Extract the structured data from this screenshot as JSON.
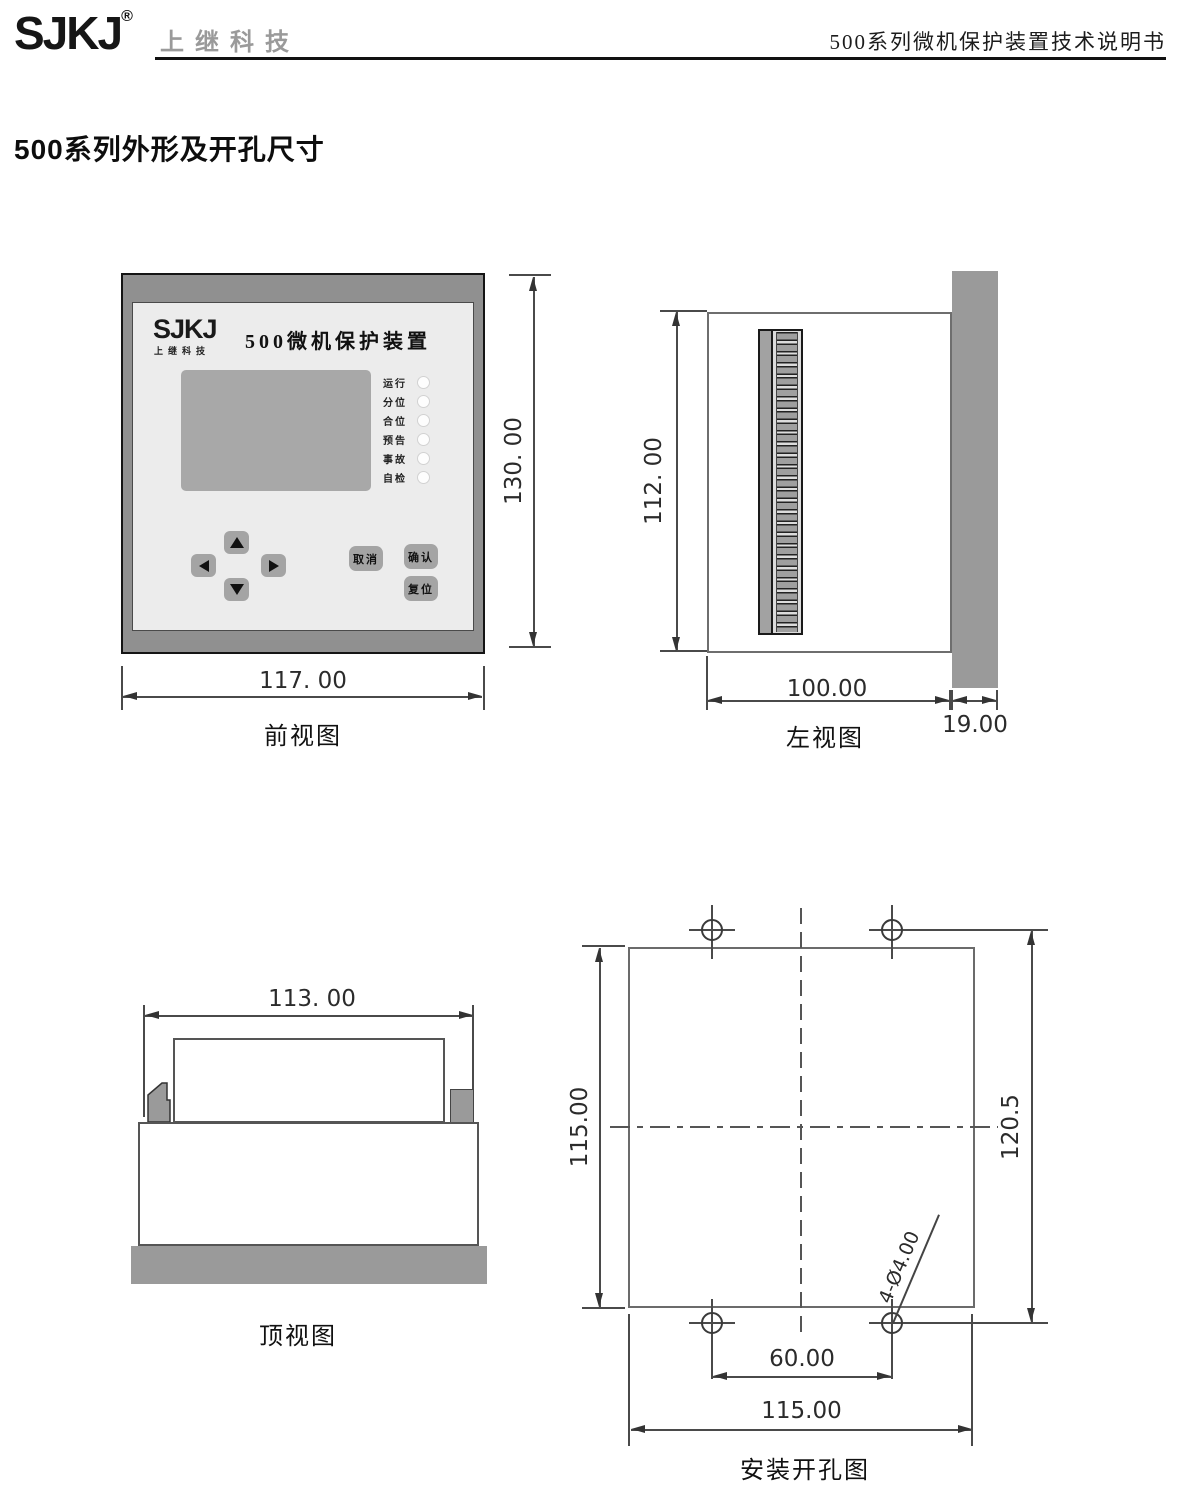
{
  "header": {
    "logo": "SJKJ",
    "logo_reg": "®",
    "logo_sub": "上继科技",
    "doc_title": "500系列微机保护装置技术说明书"
  },
  "heading": "500系列外形及开孔尺寸",
  "front": {
    "label": "前视图",
    "dim_width": "117. 00",
    "dim_height": "130. 00",
    "panel": {
      "logo": "SJKJ",
      "logo_sub": "上继科技",
      "title": "500微机保护装置",
      "leds": [
        {
          "label": "运行"
        },
        {
          "label": "分位"
        },
        {
          "label": "合位"
        },
        {
          "label": "预告"
        },
        {
          "label": "事故"
        },
        {
          "label": "自检"
        }
      ],
      "buttons": {
        "cancel": "取消",
        "confirm": "确认",
        "reset": "复位"
      }
    }
  },
  "left": {
    "label": "左视图",
    "dim_height": "112. 00",
    "dim_depth": "100.00",
    "dim_bezel": "19.00"
  },
  "top": {
    "label": "顶视图",
    "dim_width": "113. 00"
  },
  "cutout": {
    "label": "安装开孔图",
    "dim_side": "115.00",
    "dim_holes_v": "120.5",
    "dim_holes_h": "60.00",
    "dim_width": "115.00",
    "holes_note": "4-Ø4.00"
  },
  "colors": {
    "frame_gray": "#909090",
    "panel_gray": "#ececec",
    "screen_gray": "#a8a8a8",
    "bezel_gray": "#9a9a9a",
    "line_gray": "#4a4a4a"
  }
}
